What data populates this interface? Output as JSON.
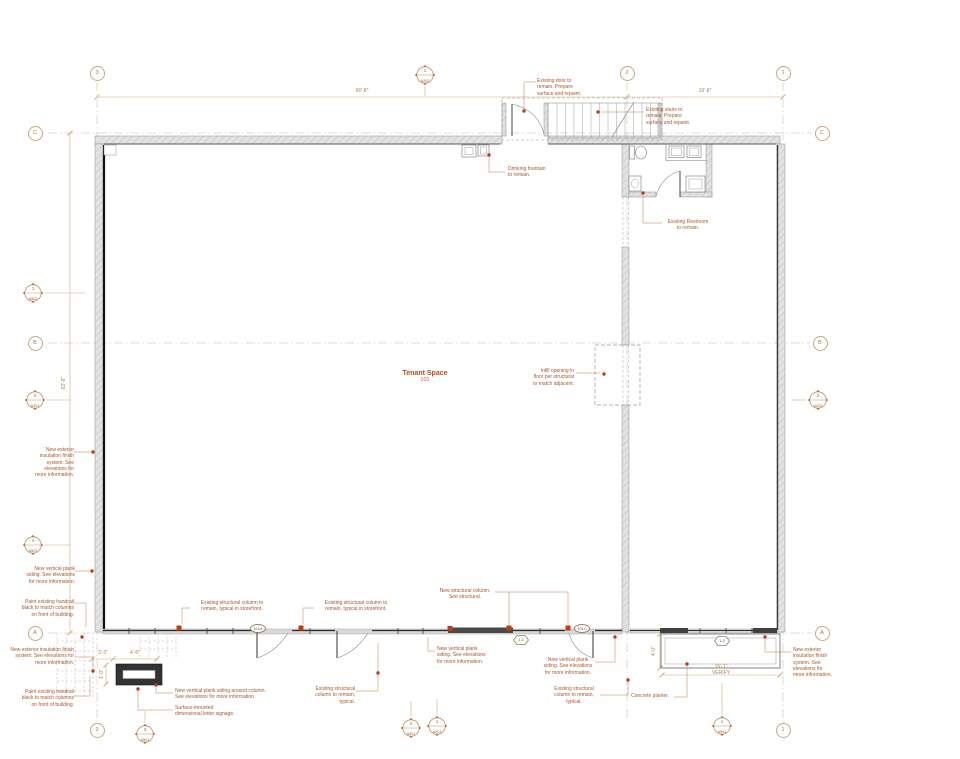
{
  "room": {
    "name": "Tenant Space",
    "number": "101"
  },
  "grid": {
    "c3": "3",
    "c2": "2",
    "c1": "1",
    "rC": "C",
    "rB": "B",
    "rA": "A"
  },
  "dims": {
    "top_main": "66'-8\"",
    "top_right": "19'-8\"",
    "left_height": "62'-8\"",
    "sign_w1": "3'-3\"",
    "sign_w2": "4'-5\"",
    "sign_h": "1'-0\"",
    "planter_depth": "4'-0\"",
    "planter_len": "15'-1\"",
    "verify": "VERIFY"
  },
  "tags": {
    "door_main": "101A",
    "door_right": "101C",
    "window_mid": "1.2",
    "window_right": "1.3"
  },
  "markers": {
    "top_a202": {
      "num": "1",
      "sheet": "A202"
    },
    "left_a502": {
      "num": "1",
      "sheet": "A502"
    },
    "left_a201": {
      "num": "2",
      "sheet": "A201"
    },
    "right_a202": {
      "num": "2",
      "sheet": "A202"
    },
    "left_a501": {
      "num": "4",
      "sheet": "A501"
    },
    "bl_a501": {
      "num": "3",
      "sheet": "A501"
    },
    "bc_a501": {
      "num": "2",
      "sheet": "A501"
    },
    "bc_a201": {
      "num": "1",
      "sheet": "A201"
    },
    "br_a501": {
      "num": "1",
      "sheet": "A501"
    }
  },
  "annotations": {
    "existing_door": "Existing door to\nremain. Prepare\nsurface and repaint.",
    "existing_stairs": "Existing stairs to\nremain. Prepare\nsurface and repaint.",
    "drinking_fountain": "Drinking fountain\nto remain.",
    "existing_restroom": "Existing Restroom\nto remain.",
    "infill_opening": "Infill opening in\nfloor per structural\nto match adjacent.",
    "eifs_narrow": "New exterior\ninsulation finish\nsystem. See\nelevations for\nmore information.",
    "eifs_wide": "New exterior insulation finish\nsystem. See elevations for\nmore information.",
    "plank_siding": "New vertical plank\nsiding. See elevations\nfor more information.",
    "handrail": "Paint existing handrail\nblack to match columns\non front of building.",
    "plank_around_column": "New vertical plank siding around column.\nSee elevations for more information.",
    "letter_signage": "Surface-mounted\ndimensional letter signage.",
    "col_storefront": "Existing structural column to\nremain, typical in storefront.",
    "new_column": "New structural column.\nSee structural.",
    "col_typical": "Existing structural\ncolumn to remain,\ntypical.",
    "concrete_planter": "Concrete planter."
  },
  "colors": {
    "annotation": "#a9572e",
    "dimension": "#a38257",
    "marker_fill": "#c2431b",
    "leader_dot": "#c13a10",
    "wall_accent": "#111111"
  }
}
